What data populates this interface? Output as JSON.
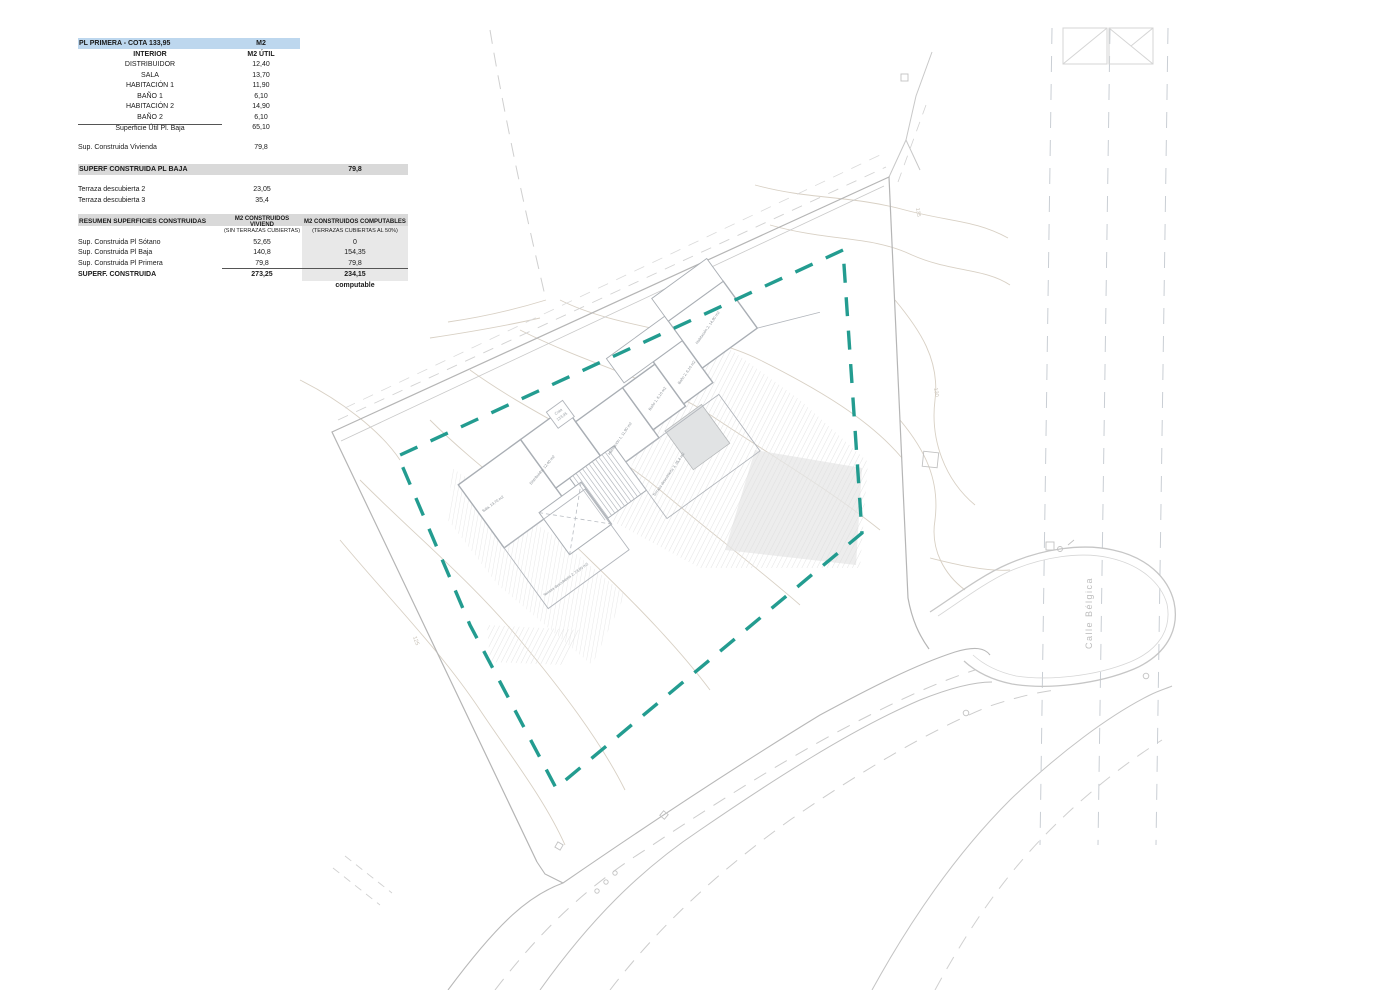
{
  "colors": {
    "teal": "#17978a",
    "table1_header_bg": "#bdd7ee",
    "gray_header_bg": "#d9d9d9",
    "column_shade": "#e8e8e8",
    "line_gray": "#b5b5b5",
    "contour": "#d8d0c4"
  },
  "table1": {
    "header": {
      "title": "PL PRIMERA - COTA 133,95",
      "unit": "M2"
    },
    "subheader": {
      "label": "INTERIOR",
      "unit": "M2 ÚTIL"
    },
    "rows": [
      {
        "label": "DISTRIBUIDOR",
        "value": "12,40"
      },
      {
        "label": "SALA",
        "value": "13,70"
      },
      {
        "label": "HABITACIÓN 1",
        "value": "11,90"
      },
      {
        "label": "BAÑO 1",
        "value": "6,10"
      },
      {
        "label": "HABITACIÓN 2",
        "value": "14,90"
      },
      {
        "label": "BAÑO 2",
        "value": "6,10"
      }
    ],
    "subtotal": {
      "label": "Superficie Útil Pl. Baja",
      "value": "65,10"
    },
    "total": {
      "label": "Sup. Construida Vivienda",
      "value": "79,8"
    }
  },
  "table2": {
    "header": {
      "title": "SUPERF CONSTRUIDA PL BAJA",
      "value": "79,8"
    },
    "rows": [
      {
        "label": "Terraza descubierta 2",
        "value": "23,05"
      },
      {
        "label": "Terraza descubierta 3",
        "value": "35,4"
      }
    ]
  },
  "table3": {
    "header": {
      "title": "RESUMEN SUPERFICIES CONSTRUIDAS",
      "col2": "M2 CONSTRUIDOS VIVIEND",
      "col3": "M2 CONSTRUIDOS COMPUTABLES"
    },
    "subheader": {
      "col2": "(SIN TERRAZAS CUBIERTAS)",
      "col3": "(TERRAZAS CUBIERTAS AL 50%)"
    },
    "rows": [
      {
        "label": "Sup. Construida Pl Sótano",
        "col2": "52,65",
        "col3": "0"
      },
      {
        "label": "Sup. Construida Pl Baja",
        "col2": "140,8",
        "col3": "154,35"
      },
      {
        "label": "Sup. Construida Pl Primera",
        "col2": "79,8",
        "col3": "79,8"
      }
    ],
    "total": {
      "label": "SUPERF. CONSTRUIDA",
      "col2": "273,25",
      "col3": "234,15"
    },
    "footnote": "computable"
  },
  "plan": {
    "street_label": "Calle  Bélgica",
    "cota_marker": {
      "line1": "Cota",
      "line2": "133,95"
    },
    "contour_labels": [
      {
        "text": "135"
      },
      {
        "text": "130"
      },
      {
        "text": "125"
      }
    ],
    "room_labels": [
      {
        "text": "Sala, 13,70 m2"
      },
      {
        "text": "Distribuidor, 12,40 m2"
      },
      {
        "text": "Habitación 1, 11,90 m2"
      },
      {
        "text": "Baño 1, 6,10 m2"
      },
      {
        "text": "Baño 2, 6,10 m2"
      },
      {
        "text": "Habitación 2, 14,90 m2"
      },
      {
        "text": "Terraza descubierta 3, 35,4 m2"
      },
      {
        "text": "Terraza descubierta 2, 23,05 m2"
      }
    ]
  }
}
